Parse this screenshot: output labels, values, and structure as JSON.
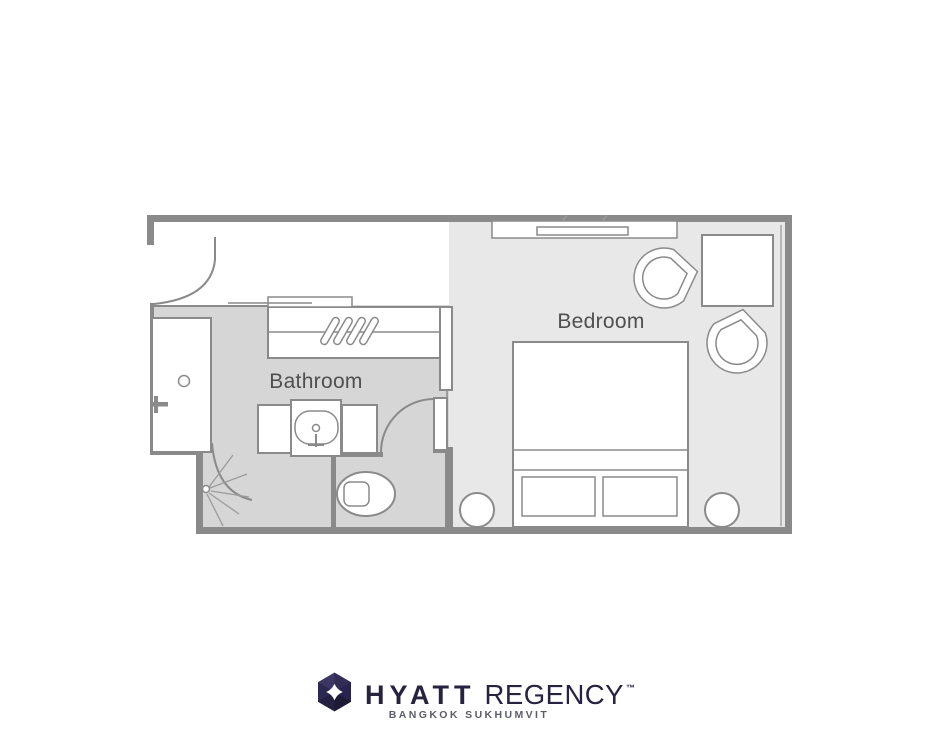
{
  "plan": {
    "rooms": {
      "bathroom": "Bathroom",
      "bedroom": "Bedroom"
    },
    "furniture_icons": [
      "entry-door-icon",
      "closet-icon",
      "hangers-icon",
      "wardrobe-panel-icon",
      "shower-stall-icon",
      "shower-door-icon",
      "shower-spray-icon",
      "shower-faucet-icon",
      "vanity-icon",
      "sink-basin-icon",
      "toilet-icon",
      "bathroom-door-icon",
      "bed-icon",
      "pillow-icon",
      "nightstand-icon",
      "tv-console-icon",
      "tv-icon",
      "lounge-chair-icon",
      "side-table-icon",
      "window-icon"
    ]
  },
  "logo": {
    "brand": "HYATT",
    "brand_suffix": "REGENCY",
    "trademark": "™",
    "subtitle": "BANGKOK SUKHUMVIT"
  },
  "colors": {
    "wall": "#8a8a8a",
    "line-light": "#9c9c9c",
    "floor-bath": "#d6d6d6",
    "floor-bed": "#e8e8e8",
    "label": "#4f4f4f",
    "navy": "#262240",
    "subtitle-color": "#5d5d68"
  }
}
